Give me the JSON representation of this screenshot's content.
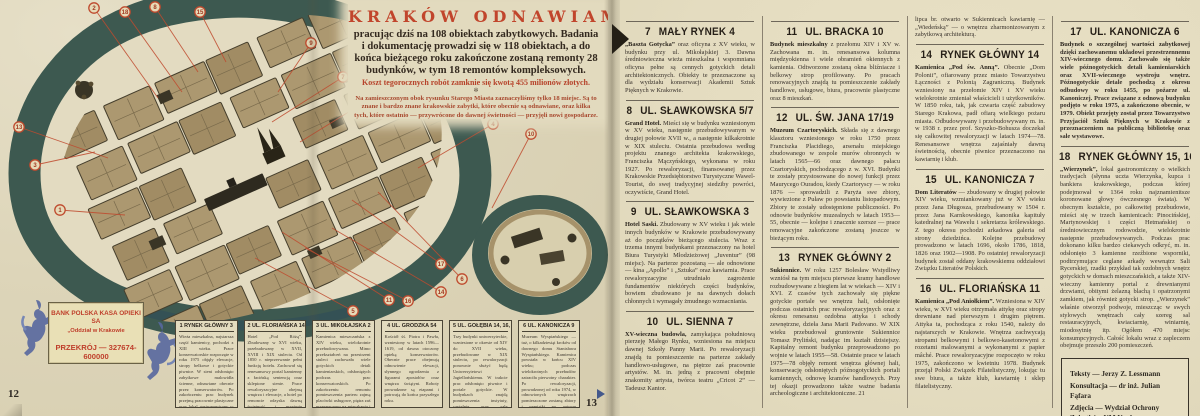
{
  "left_page": {
    "page_number_left": "12",
    "page_number_right": "13",
    "title_block": {
      "title": "KRAKÓW ODNAWIAMY",
      "lead": "pracując dziś na 108 obiektach zabytkowych. Badania i dokumentację prowadzi się w 118 obiektach, a do końca bieżącego roku zakończone zostaną remonty 28 budynków, w tym 18 remontów kompleksowych.",
      "cost": "Koszt tegorocznych robót zamknie się kwotą 455 milionów złotych.",
      "ornament": "✻",
      "note": "Na zamieszczonym obok rysunku Starego Miasta zaznaczyliśmy tylko 18 miejsc. Są to znane i bardzo znane krakowskie zabytki, które obecnie są odnawiane, oraz kilka tych, które ostatnio — przywrócone do dawnej świetności — przyjęli nowi gospodarze."
    },
    "bank_ad": {
      "line1": "BANK POLSKA KASA OPIEKI SA",
      "line2": "„Oddział w Krakowie",
      "line3": "PRZEKRÓJ — 327674-600000"
    },
    "map": {
      "badge_color": "#bf4a2e",
      "circles": [
        {
          "n": "1",
          "x": 60,
          "y": 210,
          "tx": 125,
          "ty": 215
        },
        {
          "n": "2",
          "x": 94,
          "y": 8,
          "tx": 158,
          "ty": 98
        },
        {
          "n": "3",
          "x": 35,
          "y": 165,
          "tx": 95,
          "ty": 152
        },
        {
          "n": "4",
          "x": 493,
          "y": 124,
          "tx": 418,
          "ty": 168
        },
        {
          "n": "5",
          "x": 353,
          "y": 311,
          "tx": 255,
          "ty": 258
        },
        {
          "n": "6",
          "x": 462,
          "y": 279,
          "tx": 378,
          "ty": 192
        },
        {
          "n": "7",
          "x": 343,
          "y": 77,
          "tx": 272,
          "ty": 122
        },
        {
          "n": "8",
          "x": 155,
          "y": 7,
          "tx": 198,
          "ty": 72
        },
        {
          "n": "9",
          "x": 311,
          "y": 43,
          "tx": 278,
          "ty": 92
        },
        {
          "n": "10",
          "x": 531,
          "y": 134,
          "tx": 492,
          "ty": 208
        },
        {
          "n": "11",
          "x": 389,
          "y": 300,
          "tx": 282,
          "ty": 232
        },
        {
          "n": "12",
          "x": 373,
          "y": 97,
          "tx": 300,
          "ty": 142
        },
        {
          "n": "13",
          "x": 19,
          "y": 127,
          "tx": 108,
          "ty": 158
        },
        {
          "n": "14",
          "x": 441,
          "y": 292,
          "tx": 332,
          "ty": 228
        },
        {
          "n": "15",
          "x": 200,
          "y": 12,
          "tx": 226,
          "ty": 62
        },
        {
          "n": "16",
          "x": 408,
          "y": 301,
          "tx": 305,
          "ty": 248
        },
        {
          "n": "17",
          "x": 441,
          "y": 264,
          "tx": 352,
          "ty": 200
        },
        {
          "n": "18",
          "x": 125,
          "y": 12,
          "tx": 182,
          "ty": 92
        }
      ]
    },
    "boxes": [
      {
        "num": "1",
        "title": "RYNEK GŁÓWNY 3",
        "body": "Wieża mieszkalna, najstarsza część kamienicy, pochodzi z XIII wieku. Prace konserwatorskie rozpoczęte w roku 1975 objęły elewacje, stropy belkowe i gotyckie piwnice. W sieni odsłonięto zabytkowe malowidła ścienne, odnawiane obecnie przez konserwatorów. Po zakończeniu prac budynek przejmą pracownie plastyczne oraz lokal gastronomiczny w podziemiach, wraz z zapleczem w oficynie."
      },
      {
        "num": "2",
        "title": "UL. FLORIAŃSKA 14",
        "body": "Hotel „Pod Różą”. Zbudowany w XVI wieku, przebudowany w XVII, XVIII i XIX stuleciu. Od 1850 r. nieprzerwanie pełni funkcję hotelu. Zachował się renesansowy portal kamienny z łacińską sentencją oraz sklepione sienie. Prace rewaloryzacyjne obejmą wnętrza i elewacje, a hotel po remoncie odzyska dawną świetność i przyjmie pierwszych gości."
      },
      {
        "num": "3",
        "title": "UL. MIKOŁAJSKA 2",
        "body": "Kamienica mieszczańska z XIV wieku, wielokrotnie przebudowywana. Mimo przekształceń na przestrzeni stuleci zachowała wiele gotyckich detali kamieniarskich, odsłoniętych podczas prac konserwatorskich. Po zakończeniu remontu pomieszczenia parteru zajmą placówki usługowe, piętra zaś przeznaczono na mieszkania i pracownie."
      },
      {
        "num": "4",
        "title": "UL. GRODZKA 54",
        "body": "Kościół śś. Piotra i Pawła, wzniesiony w latach 1596—1619, od dawna otoczony opieką konserwatorów. Obecnie prace obejmują odnowienie elewacji, słynnego ogrodzenia z figurami apostołów oraz wnętrza świątyni. Roboty prowadzone są etapami i potrwają do końca przyszłego roku."
      },
      {
        "num": "5",
        "title": "UL. GOŁĘBIA 14, 16, 18",
        "body": "Trzy budynki uniwersyteckie, wzniesione w okresie od XIV do XVII wieku, przebudowane w XIX stuleciu, po rewaloryzacji ponownie służyć będą Uniwersytetowi Jagiellońskiemu. W trakcie prac odsłonięto piwnice i portale gotyckie. W budynkach znajdą pomieszczenia instytuty, czytelnie oraz sale seminaryjne uczelni."
      },
      {
        "num": "6",
        "title": "UL. KANONICZA 9",
        "body": "Muzeum Wyspiańskiego — tuż, o kilkadziesiąt kroków od dawnego domu Stanisława Wyspiańskiego. Kamienica powstała w końcu XIV wieku; podczas wielokrotnych przebudów zatraciła pierwotny charakter. Po rewaloryzacji, prowadzonej od roku 1974, w odnowionych wnętrzach pomieszczone zostaną zbiory i pamiątki po autorze „Wesela”."
      }
    ]
  },
  "right_page": {
    "columns": [
      [
        {
          "num": "7",
          "title": "MAŁY RYNEK 4",
          "lead": "„Baszta Gotycka”",
          "body": " oraz oficyna z XV wieku, w budynku przy ul. Mikołajskiej 3. Dawna średniowieczna wieża mieszkalna i wspomniana oficyna pełne są cennych gotyckich detali architektonicznych. Obiekty te przeznaczone są dla wydziału konserwacji Akademii Sztuk Pięknych w Krakowie."
        },
        {
          "num": "8",
          "title": "UL. SŁAWKOWSKA 5/7",
          "lead": "Grand Hotel.",
          "body": " Mieści się w budynku wzniesionym w XV wieku, następnie przebudowywanym w drugiej połowie XVII w., a następnie kilkakrotnie w XIX stuleciu. Ostatnia przebudowa według projektu znanego architekta krakowskiego, Franciszka Mączyńskiego, wykonana w roku 1927. Po rewaloryzacji, finansowanej przez Krakowskie Przedsiębiorstwo Turystyczne Wawel-Tourist, do swej tradycyjnej siedziby powróci, oczywiście, Grand Hotel."
        },
        {
          "num": "9",
          "title": "UL. SŁAWKOWSKA 3",
          "lead": "Hotel Saski.",
          "body": " Zbudowany w XV wieku i jak wiele innych budynków w Krakowie przebudowywany aż do początków bieżącego stulecia. Wraz z trzema innymi budynkami przeznaczony na hotel Biura Turystyki Młodzieżowej „Juventur” (98 miejsc). Na parterze pozostaną — ale odnowione — kina „Apollo” i „Sztuka” oraz kawiarnia. Prace rewaloryzacyjne utrudniało zagrożenie fundamentów niektórych części budynków, bowiem zbudowano je na dawnych dołach chłonnych i wymagały żmudnego wzmacniania."
        },
        {
          "num": "10",
          "title": "UL. SIENNA 7",
          "lead": "XV-wieczna budowla,",
          "body": " zamykająca południową pierzeję Małego Rynku, wzniesiona na miejscu dawnej Szkoły Panny Marii. Po rewaloryzacji znajdą tu pomieszczenie na parterze zakłady handlowo-usługowe, na piętrze zaś pracownie artystów. M. in. jedną z pracowni obejmie znakomity artysta, twórca teatru „Cricot 2” — Tadeusz Kantor."
        }
      ],
      [
        {
          "num": "11",
          "title": "UL. BRACKA 10",
          "lead": "Budynek mieszkalny",
          "body": " z przełomu XIV i XV w. Zachowana m. in. renesansowa kolumna międzyokienna i wiele obramień okiennych z kamienia. Odtworzone zostaną okna bliźniacze i belkowy strop profilowany. Po pracach renowacyjnych znajdą tu pomieszczenie zakłady handlowe, usługowe, biura, pracownie plastyczne oraz 8 mieszkań."
        },
        {
          "num": "12",
          "title": "UL. ŚW. JANA 17/19",
          "lead": "Muzeum Czartoryskich.",
          "body": " Składa się z dawnego klasztoru wzniesionego w roku 1750 przez Franciszka Placidiego, arsenału miejskiego zbudowanego w zespole murów obronnych w latach 1565—66 oraz dawnego pałacu Czartoryskich, pochodzącego z w. XVI. Budynki te zostały przystosowane do nowej funkcji przez Maurycego Ouradou, kiedy Czartoryscy — w roku 1876 — sprowadzili z Paryża swe zbiory, wywiezione z Puław po powstaniu listopadowym. Zbiory te zostały udostępnione publiczności. Po odnowie budynków muzealnych w latach 1953—55, obecnie — kolejne i znacznie szersze — prace renowacyjne zakończone zostaną jeszcze w bieżącym roku."
        },
        {
          "num": "13",
          "title": "RYNEK GŁÓWNY 2",
          "lead": "Sukiennice.",
          "body": " W roku 1257 Bolesław Wstydliwy wzniósł na tym miejscu pierwsze kramy handlowe rozbudowywane z biegiem lat w wiekach — XIV i XVI. Z czasów tych zachowały się piękne gotyckie portale we wnętrzu hali, odsłonięte podczas ostatnich prac rewaloryzacyjnych oraz z okresu renesansu ozdobna attyka i schody zewnętrzne, dzieła Jana Marii Padovano. W XIX wieku przebudował gruntownie Sukiennice Tomasz Pryliński, nadając im kształt dzisiejszy. Kapitalny remont budynku przeprowadzono po wojnie w latach 1955—58. Ostatnie prace w latach 1975—78 objęły remont wnętrza głównej hali, konserwację odsłoniętych późnogotyckich portali kamiennych, odnowę kramów handlowych. Przy tej okazji prowadzono także ważne badania archeologiczne i architektoniczne. 21"
        }
      ],
      [
        {
          "continuation": true,
          "body": "lipca br. otwarto w Sukiennicach kawiarnię — „Wiedeńską” — o wnętrzu zharmonizowanym z zabytkową architekturą."
        },
        {
          "num": "14",
          "title": "RYNEK GŁÓWNY 14",
          "lead": "Kamienica „Pod św. Anną”.",
          "body": " Obecnie „Dom Polonii”, ofiarowany przez miasto Towarzystwu Łączności z Polonią Zagraniczną. Budynek wzniesiony na przełomie XIV i XV wieku wielokrotnie zmieniał właścicieli i użytkowników. W 1850 roku, tak, jak czwarta część zabudowy Starego Krakowa, padł ofiarą wielkiego pożaru miasta. Odbudowywany i przebudowywany m. in. w 1938 r. przez prof. Szyszko-Bohusza doczekał się całkowitej rewaloryzacji w latach 1974—78. Renesansowe wnętrza zajaśniały dawną świetnością, obecnie piwnice przeznaczono na kawiarnię i klub."
        },
        {
          "num": "15",
          "title": "UL. KANONICZA 7",
          "lead": "Dom Literatów",
          "body": " — zbudowany w drugiej połowie XIV wieku, wzmiankowany już w XV wieku przez Jana Długosza, przebudowany w 1504 r. przez Jana Karnkowskiego, kanonika kapituły katedralnej na Wawelu i sekretarza królewskiego. Z tego okresu pochodzi arkadowa galeria od strony dziedzińca. Kolejne przebudowy prowadzono w latach 1696, około 1786, 1818, 1826 oraz 1902—1908. Po ostatniej rewaloryzacji budynek został oddany krakowskiemu oddziałowi Związku Literatów Polskich."
        },
        {
          "num": "16",
          "title": "UL. FLORIAŃSKA 11",
          "lead": "Kamienica „Pod Aniołkiem”.",
          "body": " Wzniesiona w XIV wieku, w XVI wieku otrzymała attykę oraz stropy drewniane nad pierwszym i drugim piętrem. Attyka ta, pochodząca z roku 1540, należy do najstarszych w Krakowie. Wnętrza zachwycają stropami belkowymi i belkowo-kasetonowymi z rozetami malowanymi a wykonanymi z papier mâché. Prace rewaloryzacyjne rozpoczęto w roku 1975, zakończono w kwietniu 1978. Budynek przejął Polski Związek Filatelistyczny, lokując tu swe biura, a także klub, kawiarnię i sklep filatelistyczny."
        }
      ],
      [
        {
          "num": "17",
          "title": "UL. KANONICZA 6",
          "allbold": true,
          "lead": "Budynek o szczególnej wartości zabytkowej",
          "body": " dzięki zachowanemu układowi przestrzennemu XIV-wiecznego domu. Zachowało się także wiele późnogotyckich detali kamieniarskich oraz XVII-wiecznego wystroju wnętrz. Późnogotyckie detale pochodzą z okresu odbudowy w roku 1455, po pożarze ul. Kanoniczej. Prace związane z odnową budynku podjęto w roku 1975, a zakończono obecnie, w 1979. Obiekt przejęty został przez Towarzystwo Przyjaciół Sztuk Pięknych w Krakowie z przeznaczeniem na publiczną bibliotekę oraz sale wystawowe."
        },
        {
          "num": "18",
          "title": "RYNEK GŁÓWNY 15, 16 i 17",
          "lead": "„Wierzynek”,",
          "body": " lokal gastronomiczny o wielkich tradycjach (słynna uczta Wierzynka, kupca i bankiera krakowskiego, podczas której podejmował w 1364 roku najznamienitsze koronowane głowy ówczesnego świata). W obecnym kształcie, po całkowitej przebudowie, mieści się w trzech kamienicach: Pinocińskiej, Martynowskiej i części Hetmańskiej o średniowiecznym rodowodzie, wielokrotnie następnie przebudowywanych. Podczas prac dokonano kilku bardzo ciekawych odkryć, m. in. odsłonięto 3 kamienne rzeźbione wsporniki, podtrzymujące ceglane arkady wewnątrz Sali Rycerskiej, rzadki przykład tak ozdobnych wnętrz gotyckich w domach mieszczańskich, a także XIV-wieczny kamienny portal z drewnianymi drzwiami, obitymi żelazną blachą i opatrzonymi zamkiem, jak również gotycki strop. „Wierzynek” właśnie otworzył podwoje, mieszcząc w swych stylowych wnętrzach cały szereg sal restauracyjnych, kwiaciarnię, winiarnię, miodosytnię itp. Ogółem 470 miejsc konsumpcyjnych. Całość lokalu wraz z zapleczem obejmuje przeszło 200 pomieszczeń."
        }
      ]
    ]
  },
  "credits": {
    "lines": [
      "Teksty — Jerzy Z. Lessmann",
      "Konsultacja — dr inż. Julian Fąfara",
      "Zdjęcia — Wydział Ochrony Zabytków UM Krakowa"
    ]
  }
}
